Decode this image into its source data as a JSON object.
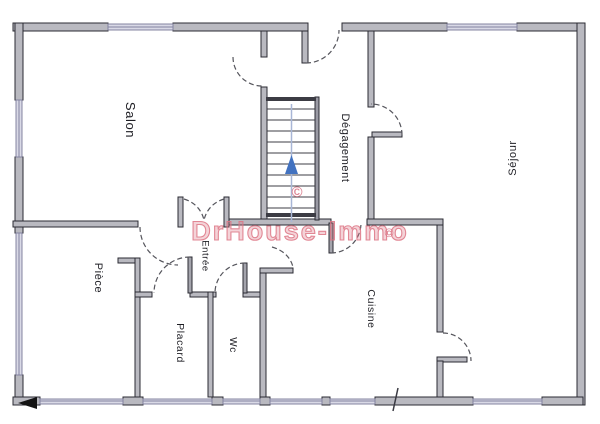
{
  "plan": {
    "watermark_text": "DrHouse-Immo",
    "copyright_symbol": "©"
  },
  "rooms": {
    "salon": "Salon",
    "degagement": "Dégagement",
    "sejour": "Séjour",
    "piece": "Pièce",
    "entree": "Entrée",
    "placard": "Placard",
    "wc": "Wc",
    "cuisine": "Cuisine"
  },
  "colors": {
    "wallFill": "#b9b9c0",
    "wallStroke": "#2b2b33",
    "leafFill": "#a4a4ac",
    "windowFill": "#d9d9e6",
    "windowStroke": "#8484a0",
    "arcColor": "#55555c",
    "treadColor": "#3c3c44",
    "stairLine": "#a8b6d6",
    "arrowColor": "#4272c0",
    "watermark": "#dd7585",
    "copyrightColor": "#d4677a",
    "triangleColor": "#141414"
  }
}
